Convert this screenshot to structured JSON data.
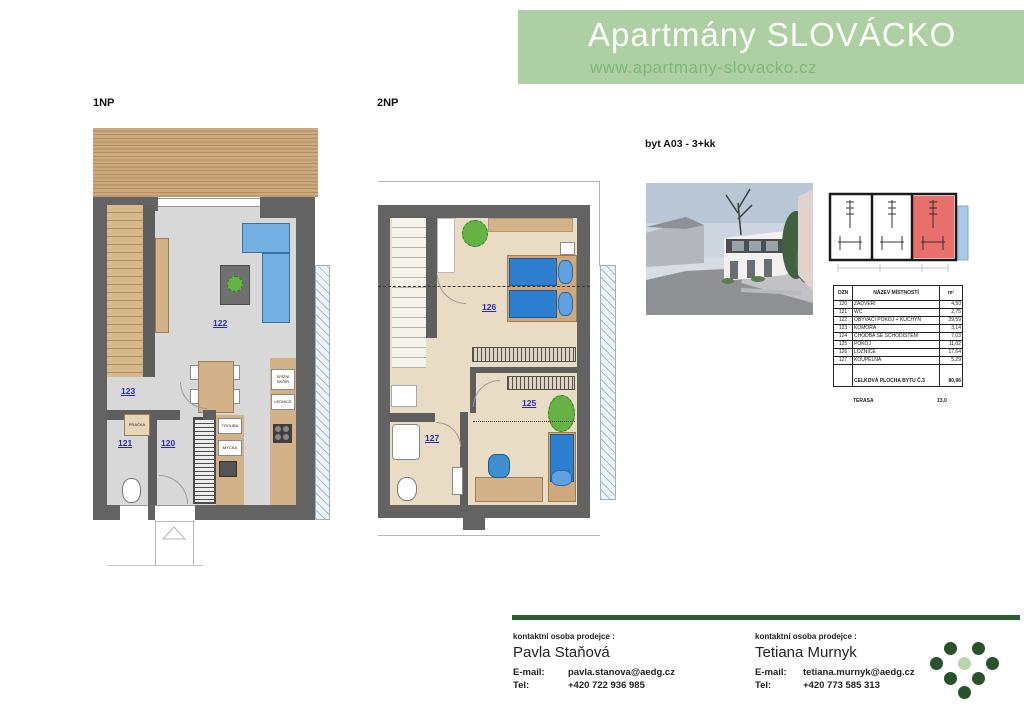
{
  "header": {
    "title": "Apartmány SLOVÁCKO",
    "url": "www.apartmany-slovacko.cz"
  },
  "plans": {
    "unit_label": "byt A03 - 3+kk",
    "floor1": {
      "label": "1NP",
      "rooms": {
        "r120": "120",
        "r121": "121",
        "r122": "122",
        "r123": "123"
      },
      "appliances": {
        "spiz": "SPÍŽNÍ SKŘÍŇ",
        "lednice": "LEDNICE",
        "trouba": "TROUBA",
        "mycka": "MYČKA",
        "pracka": "PRAČKA"
      }
    },
    "floor2": {
      "label": "2NP",
      "rooms": {
        "r124": "124",
        "r125": "125",
        "r126": "126",
        "r127": "127"
      }
    }
  },
  "room_table": {
    "headers": [
      "OZN",
      "NÁZEV MÍSTNOSTÍ",
      "m²"
    ],
    "rows": [
      [
        "120",
        "ZÁDVEŘÍ",
        "4,50"
      ],
      [
        "121",
        "WC",
        "2,75"
      ],
      [
        "122",
        "OBÝVACÍ POKOJ + KUCHYŇ",
        "29,59"
      ],
      [
        "123",
        "KOMORA",
        "3,14"
      ],
      [
        "124",
        "CHODBA SE SCHODIŠTĚM",
        "7,03"
      ],
      [
        "125",
        "POKOJ",
        "11,02"
      ],
      [
        "126",
        "LOŽNICE",
        "17,64"
      ],
      [
        "127",
        "KOUPELNA",
        "5,29"
      ]
    ],
    "total_label": "CELKOVÁ PLOCHA BYTU Č.3",
    "total_value": "80,96",
    "terasa_label": "TERASA",
    "terasa_value": "13,0"
  },
  "contacts": [
    {
      "heading": "kontaktní osoba prodejce :",
      "name": "Pavla Staňová",
      "email_label": "E-mail:",
      "email": "pavla.stanova@aedg.cz",
      "tel_label": "Tel:",
      "tel": "+420 722 936 985"
    },
    {
      "heading": "kontaktní osoba prodejce :",
      "name": "Tetiana Murnyk",
      "email_label": "E-mail:",
      "email": "tetiana.murnyk@aedg.cz",
      "tel_label": "Tel:",
      "tel": "+420 773 585 313"
    }
  ],
  "colors": {
    "banner_green": "#aecfa3",
    "banner_url_green": "#7db77c",
    "dark_green_bar": "#2b5c33",
    "logo_dark_green": "#27522a",
    "logo_light_green": "#b7d6b0",
    "wall_gray": "#636363",
    "wood_tan": "#d4b289",
    "furniture_blue": "#74b0e2",
    "bed_blue": "#2f7fd0",
    "room_number_blue": "#2a2ab8",
    "site_unit_red": "#e96f6c",
    "site_strip_blue": "#abc8e6",
    "plant_green": "#67b244"
  }
}
